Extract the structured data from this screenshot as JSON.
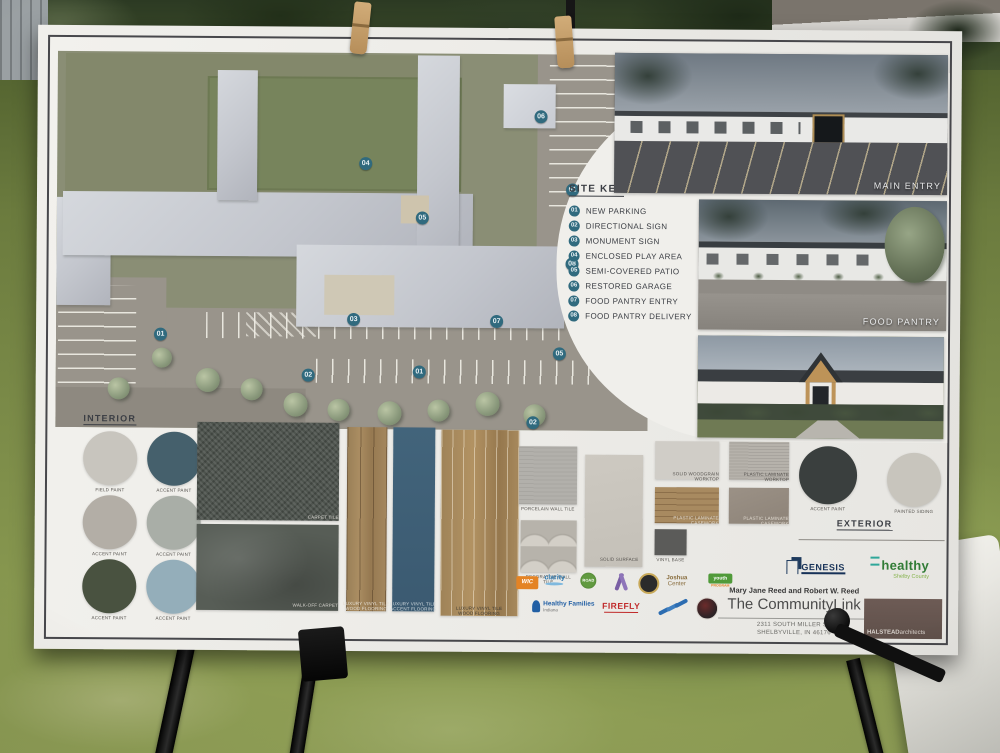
{
  "site_key": {
    "title": "SITE KEY",
    "items": [
      {
        "num": "01",
        "label": "NEW PARKING"
      },
      {
        "num": "02",
        "label": "DIRECTIONAL SIGN"
      },
      {
        "num": "03",
        "label": "MONUMENT SIGN"
      },
      {
        "num": "04",
        "label": "ENCLOSED PLAY AREA"
      },
      {
        "num": "05",
        "label": "SEMI-COVERED PATIO"
      },
      {
        "num": "06",
        "label": "RESTORED GARAGE"
      },
      {
        "num": "07",
        "label": "FOOD PANTRY ENTRY"
      },
      {
        "num": "08",
        "label": "FOOD PANTRY DELIVERY"
      }
    ]
  },
  "plan": {
    "marker_color": "#2e6b80",
    "markers": [
      "04",
      "06",
      "01",
      "05",
      "08",
      "03",
      "07",
      "05",
      "02",
      "01",
      "02",
      "01"
    ]
  },
  "photos": {
    "main_entry_label": "MAIN ENTRY",
    "food_pantry_label": "FOOD PANTRY"
  },
  "interior": {
    "title": "INTERIOR",
    "swatches": [
      {
        "label": "FIELD PAINT",
        "color": "#c8c5be"
      },
      {
        "label": "ACCENT PAINT",
        "color": "#44606d"
      },
      {
        "label": "ACCENT PAINT",
        "color": "#b3aea6"
      },
      {
        "label": "ACCENT PAINT",
        "color": "#a9aea7"
      },
      {
        "label": "ACCENT PAINT",
        "color": "#49523f"
      },
      {
        "label": "ACCENT PAINT",
        "color": "#93aebb"
      }
    ]
  },
  "materials": {
    "carpet_tile": "CARPET TILE",
    "walk_off_carpet": "WALK-OFF CARPET",
    "lvt_wood_1": "LUXURY VINYL TILE WOOD FLOORING",
    "lvt_accent": "LUXURY VINYL TILE ACCENT FLOORING",
    "lvt_wood_2": "LUXURY VINYL TILE WOOD FLOORING",
    "wall_tile": "PORCELAIN WALL TILE",
    "decorative_tile": "DECORATIVE WALL TILE",
    "solid_surface": "SOLID SURFACE",
    "laminate_worktop_1": "SOLID WOODGRAIN WORKTOP",
    "laminate_worktop_2": "PLASTIC LAMINATE WORKTOP",
    "laminate_casework_1": "PLASTIC LAMINATE CASEWORK",
    "laminate_casework_2": "PLASTIC LAMINATE CASEWORK",
    "vinyl_base": "VINYL BASE"
  },
  "exterior": {
    "title": "EXTERIOR",
    "swatches": [
      {
        "label": "ACCENT PAINT",
        "color": "#3a3f3e"
      },
      {
        "label": "PAINTED SIDING",
        "color": "#c8c5bd"
      }
    ]
  },
  "partners": {
    "wic": "WIC",
    "clarity": "clarity",
    "road": "ROAD",
    "joshua_line1": "Joshua",
    "joshua_line2": "Center",
    "youth_line1": "youth",
    "youth_line2": "PROGRAM",
    "healthy_families_line1": "Healthy Families",
    "healthy_families_line2": "Indiana",
    "firefly": "FIREFLY"
  },
  "credits": {
    "genesis": "GENESIS",
    "healthy": "healthy",
    "healthy_sub": "Shelby County",
    "names": "Mary Jane Reed and Robert W. Reed",
    "org": "The CommunityLink",
    "address_line1": "2311 SOUTH MILLER ST",
    "address_line2": "SHELBYVILLE, IN 46176",
    "architect_bold": "HALSTEAD",
    "architect_rest": "architects"
  }
}
